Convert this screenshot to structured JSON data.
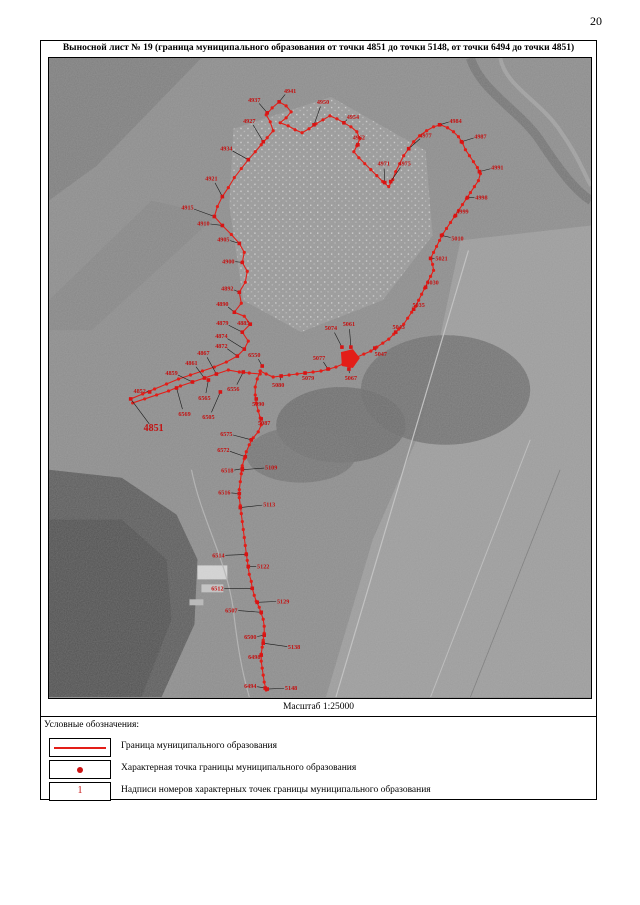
{
  "page": {
    "number": "20"
  },
  "sheet": {
    "title": "Выносной лист № 19 (граница муниципального образования от точки 4851 до точки 5148, от точки 6494 до точки 4851)",
    "scale_label": "Масштаб 1:25000"
  },
  "legend": {
    "heading": "Условные обозначения:",
    "items": [
      {
        "symbol": "boundary-line-symbol",
        "label": "Граница муниципального образования"
      },
      {
        "symbol": "boundary-point-symbol",
        "label": "Характерная точка границы муниципального образования"
      },
      {
        "symbol": "point-number-symbol",
        "label": "Надписи номеров характерных точек границы муниципального образования",
        "sample": "1"
      }
    ]
  },
  "colors": {
    "boundary": "#e31e18",
    "point": "#d81414",
    "label": "#c41111",
    "leader": "#1a1a1a",
    "map_base": "#8c8c8c"
  },
  "map": {
    "points": [
      {
        "n": "4851",
        "x": 152,
        "y": 428,
        "px": 129,
        "py": 399,
        "b": true
      },
      {
        "n": "4852",
        "x": 138,
        "y": 391,
        "px": 148,
        "py": 392
      },
      {
        "n": "4859",
        "x": 170,
        "y": 373,
        "px": 191,
        "py": 382
      },
      {
        "n": "4861",
        "x": 190,
        "y": 363,
        "px": 203,
        "py": 378
      },
      {
        "n": "4867",
        "x": 202,
        "y": 353,
        "px": 215,
        "py": 374
      },
      {
        "n": "4872",
        "x": 220,
        "y": 346,
        "px": 236,
        "py": 356
      },
      {
        "n": "4874",
        "x": 220,
        "y": 336,
        "px": 243,
        "py": 349
      },
      {
        "n": "4879",
        "x": 221,
        "y": 323,
        "px": 241,
        "py": 332
      },
      {
        "n": "4885",
        "x": 242,
        "y": 323,
        "px": 249,
        "py": 324
      },
      {
        "n": "4890",
        "x": 221,
        "y": 304,
        "px": 233,
        "py": 312
      },
      {
        "n": "4892",
        "x": 226,
        "y": 288,
        "px": 238,
        "py": 292
      },
      {
        "n": "4900",
        "x": 227,
        "y": 261,
        "px": 241,
        "py": 262
      },
      {
        "n": "4905",
        "x": 222,
        "y": 239,
        "px": 238,
        "py": 243
      },
      {
        "n": "4910",
        "x": 202,
        "y": 223,
        "px": 221,
        "py": 225
      },
      {
        "n": "4915",
        "x": 186,
        "y": 207,
        "px": 213,
        "py": 216
      },
      {
        "n": "4921",
        "x": 210,
        "y": 178,
        "px": 221,
        "py": 196
      },
      {
        "n": "4927",
        "x": 248,
        "y": 120,
        "px": 262,
        "py": 141
      },
      {
        "n": "4934",
        "x": 225,
        "y": 148,
        "px": 247,
        "py": 159
      },
      {
        "n": "4937",
        "x": 253,
        "y": 99,
        "px": 266,
        "py": 112
      },
      {
        "n": "4941",
        "x": 289,
        "y": 90,
        "px": 278,
        "py": 101
      },
      {
        "n": "4950",
        "x": 322,
        "y": 101,
        "px": 313,
        "py": 124
      },
      {
        "n": "4954",
        "x": 352,
        "y": 116,
        "px": 343,
        "py": 122
      },
      {
        "n": "4962",
        "x": 358,
        "y": 137,
        "px": 357,
        "py": 144
      },
      {
        "n": "4971",
        "x": 383,
        "y": 163,
        "px": 384,
        "py": 182
      },
      {
        "n": "4975",
        "x": 404,
        "y": 163,
        "px": 390,
        "py": 181
      },
      {
        "n": "4977",
        "x": 425,
        "y": 135,
        "px": 408,
        "py": 148
      },
      {
        "n": "4984",
        "x": 455,
        "y": 120,
        "px": 439,
        "py": 124
      },
      {
        "n": "4987",
        "x": 480,
        "y": 136,
        "px": 461,
        "py": 141
      },
      {
        "n": "4991",
        "x": 497,
        "y": 167,
        "px": 479,
        "py": 171
      },
      {
        "n": "4998",
        "x": 481,
        "y": 197,
        "px": 467,
        "py": 197
      },
      {
        "n": "4999",
        "x": 462,
        "y": 211,
        "px": 455,
        "py": 215
      },
      {
        "n": "5010",
        "x": 457,
        "y": 238,
        "px": 441,
        "py": 235
      },
      {
        "n": "5021",
        "x": 441,
        "y": 258,
        "px": 430,
        "py": 258
      },
      {
        "n": "5030",
        "x": 432,
        "y": 282,
        "px": 425,
        "py": 287
      },
      {
        "n": "5035",
        "x": 418,
        "y": 305,
        "px": 413,
        "py": 309
      },
      {
        "n": "5043",
        "x": 398,
        "y": 327,
        "px": 395,
        "py": 332
      },
      {
        "n": "5047",
        "x": 380,
        "y": 354,
        "px": 374,
        "py": 348
      },
      {
        "n": "5061",
        "x": 348,
        "y": 324,
        "px": 350,
        "py": 347
      },
      {
        "n": "5074",
        "x": 330,
        "y": 328,
        "px": 341,
        "py": 347
      },
      {
        "n": "5077",
        "x": 318,
        "y": 358,
        "px": 327,
        "py": 369
      },
      {
        "n": "5067",
        "x": 350,
        "y": 378,
        "px": 348,
        "py": 369
      },
      {
        "n": "5079",
        "x": 307,
        "y": 378,
        "px": 304,
        "py": 373
      },
      {
        "n": "5080",
        "x": 277,
        "y": 385,
        "px": 280,
        "py": 376
      },
      {
        "n": "6550",
        "x": 253,
        "y": 355,
        "px": 261,
        "py": 366
      },
      {
        "n": "6556",
        "x": 232,
        "y": 389,
        "px": 242,
        "py": 372
      },
      {
        "n": "6565",
        "x": 203,
        "y": 398,
        "px": 207,
        "py": 380
      },
      {
        "n": "6569",
        "x": 183,
        "y": 414,
        "px": 175,
        "py": 388
      },
      {
        "n": "6505",
        "x": 207,
        "y": 417,
        "px": 219,
        "py": 392
      },
      {
        "n": "5090",
        "x": 257,
        "y": 404,
        "px": 255,
        "py": 399
      },
      {
        "n": "5087",
        "x": 263,
        "y": 423,
        "px": 260,
        "py": 419
      },
      {
        "n": "6575",
        "x": 225,
        "y": 434,
        "px": 250,
        "py": 440
      },
      {
        "n": "6572",
        "x": 222,
        "y": 450,
        "px": 244,
        "py": 457
      },
      {
        "n": "6518",
        "x": 226,
        "y": 471,
        "px": 241,
        "py": 469
      },
      {
        "n": "5109",
        "x": 270,
        "y": 468,
        "px": 241,
        "py": 470
      },
      {
        "n": "6516",
        "x": 223,
        "y": 493,
        "px": 238,
        "py": 494
      },
      {
        "n": "5113",
        "x": 268,
        "y": 505,
        "px": 239,
        "py": 508
      },
      {
        "n": "6514",
        "x": 217,
        "y": 556,
        "px": 245,
        "py": 555
      },
      {
        "n": "5122",
        "x": 262,
        "y": 567,
        "px": 247,
        "py": 567
      },
      {
        "n": "6512",
        "x": 216,
        "y": 589,
        "px": 251,
        "py": 589
      },
      {
        "n": "5129",
        "x": 282,
        "y": 602,
        "px": 256,
        "py": 603
      },
      {
        "n": "6507",
        "x": 230,
        "y": 611,
        "px": 260,
        "py": 613
      },
      {
        "n": "6500",
        "x": 249,
        "y": 638,
        "px": 263,
        "py": 636
      },
      {
        "n": "5138",
        "x": 293,
        "y": 648,
        "px": 262,
        "py": 644
      },
      {
        "n": "6498",
        "x": 253,
        "y": 658,
        "px": 260,
        "py": 656
      },
      {
        "n": "6494",
        "x": 249,
        "y": 687,
        "px": 264,
        "py": 689
      },
      {
        "n": "5148",
        "x": 290,
        "y": 689,
        "px": 266,
        "py": 690
      }
    ],
    "paths": {
      "outer": [
        [
          129,
          399
        ],
        [
          141,
          394
        ],
        [
          153,
          389
        ],
        [
          165,
          384
        ],
        [
          177,
          379
        ],
        [
          189,
          375
        ],
        [
          201,
          371
        ],
        [
          213,
          367
        ],
        [
          225,
          362
        ],
        [
          236,
          356
        ],
        [
          243,
          349
        ],
        [
          247,
          341
        ],
        [
          241,
          332
        ],
        [
          249,
          324
        ],
        [
          243,
          316
        ],
        [
          233,
          312
        ],
        [
          240,
          303
        ],
        [
          238,
          292
        ],
        [
          244,
          282
        ],
        [
          246,
          271
        ],
        [
          241,
          262
        ],
        [
          243,
          252
        ],
        [
          238,
          243
        ],
        [
          230,
          234
        ],
        [
          221,
          225
        ],
        [
          213,
          216
        ],
        [
          216,
          206
        ],
        [
          221,
          196
        ],
        [
          227,
          187
        ],
        [
          233,
          177
        ],
        [
          240,
          168
        ],
        [
          247,
          159
        ],
        [
          254,
          151
        ],
        [
          260,
          144
        ],
        [
          266,
          137
        ],
        [
          272,
          130
        ],
        [
          269,
          121
        ],
        [
          265,
          114
        ],
        [
          271,
          107
        ],
        [
          278,
          101
        ],
        [
          285,
          105
        ],
        [
          290,
          111
        ],
        [
          285,
          117
        ],
        [
          279,
          122
        ],
        [
          287,
          125
        ],
        [
          294,
          129
        ],
        [
          301,
          132
        ],
        [
          308,
          128
        ],
        [
          315,
          123
        ],
        [
          322,
          119
        ],
        [
          329,
          115
        ],
        [
          336,
          118
        ],
        [
          343,
          122
        ],
        [
          350,
          126
        ],
        [
          356,
          131
        ],
        [
          359,
          138
        ],
        [
          356,
          145
        ],
        [
          353,
          151
        ],
        [
          358,
          157
        ],
        [
          364,
          163
        ],
        [
          370,
          169
        ],
        [
          376,
          175
        ],
        [
          382,
          181
        ],
        [
          388,
          186
        ],
        [
          392,
          179
        ],
        [
          395,
          171
        ],
        [
          399,
          163
        ],
        [
          403,
          155
        ],
        [
          408,
          148
        ],
        [
          413,
          141
        ],
        [
          419,
          135
        ],
        [
          426,
          130
        ],
        [
          433,
          126
        ],
        [
          440,
          124
        ],
        [
          447,
          127
        ],
        [
          453,
          131
        ],
        [
          458,
          136
        ],
        [
          462,
          142
        ],
        [
          465,
          149
        ],
        [
          469,
          155
        ],
        [
          473,
          161
        ],
        [
          477,
          167
        ],
        [
          480,
          173
        ],
        [
          478,
          180
        ],
        [
          474,
          186
        ],
        [
          470,
          192
        ],
        [
          466,
          198
        ],
        [
          462,
          204
        ],
        [
          458,
          210
        ],
        [
          454,
          216
        ],
        [
          450,
          222
        ],
        [
          446,
          228
        ],
        [
          442,
          234
        ],
        [
          439,
          240
        ],
        [
          436,
          246
        ],
        [
          433,
          252
        ],
        [
          430,
          258
        ],
        [
          432,
          264
        ],
        [
          433,
          270
        ],
        [
          430,
          276
        ],
        [
          427,
          282
        ],
        [
          424,
          288
        ],
        [
          421,
          294
        ],
        [
          418,
          300
        ],
        [
          415,
          306
        ],
        [
          411,
          312
        ],
        [
          407,
          318
        ],
        [
          403,
          324
        ],
        [
          398,
          329
        ],
        [
          393,
          334
        ],
        [
          388,
          339
        ],
        [
          382,
          343
        ],
        [
          376,
          347
        ],
        [
          370,
          351
        ],
        [
          363,
          354
        ],
        [
          356,
          357
        ],
        [
          349,
          361
        ],
        [
          342,
          364
        ],
        [
          335,
          367
        ],
        [
          328,
          369
        ],
        [
          320,
          371
        ],
        [
          312,
          372
        ],
        [
          304,
          373
        ],
        [
          296,
          374
        ],
        [
          288,
          375
        ],
        [
          280,
          376
        ],
        [
          272,
          377
        ],
        [
          265,
          374
        ],
        [
          259,
          371
        ]
      ],
      "parallel": [
        [
          131,
          403
        ],
        [
          143,
          399
        ],
        [
          155,
          395
        ],
        [
          167,
          391
        ],
        [
          179,
          386
        ],
        [
          191,
          382
        ],
        [
          203,
          378
        ],
        [
          215,
          374
        ],
        [
          227,
          370
        ],
        [
          238,
          372
        ],
        [
          248,
          373
        ],
        [
          259,
          374
        ]
      ],
      "south": [
        [
          259,
          371
        ],
        [
          256,
          379
        ],
        [
          254,
          387
        ],
        [
          254,
          395
        ],
        [
          255,
          403
        ],
        [
          257,
          411
        ],
        [
          259,
          418
        ],
        [
          260,
          425
        ],
        [
          257,
          432
        ],
        [
          252,
          438
        ],
        [
          248,
          445
        ],
        [
          245,
          452
        ],
        [
          243,
          459
        ],
        [
          241,
          466
        ],
        [
          240,
          474
        ],
        [
          239,
          482
        ],
        [
          238,
          490
        ],
        [
          238,
          498
        ],
        [
          239,
          506
        ],
        [
          240,
          514
        ],
        [
          241,
          522
        ],
        [
          242,
          530
        ],
        [
          243,
          538
        ],
        [
          244,
          546
        ],
        [
          245,
          554
        ],
        [
          246,
          561
        ],
        [
          247,
          568
        ],
        [
          248,
          575
        ],
        [
          250,
          582
        ],
        [
          251,
          589
        ],
        [
          253,
          596
        ],
        [
          255,
          602
        ],
        [
          258,
          608
        ],
        [
          260,
          614
        ],
        [
          262,
          620
        ],
        [
          263,
          627
        ],
        [
          263,
          634
        ],
        [
          262,
          641
        ],
        [
          261,
          648
        ],
        [
          260,
          655
        ],
        [
          260,
          662
        ],
        [
          261,
          669
        ],
        [
          262,
          676
        ],
        [
          263,
          683
        ],
        [
          265,
          691
        ]
      ]
    },
    "blob": [
      [
        340,
        352
      ],
      [
        352,
        349
      ],
      [
        359,
        358
      ],
      [
        352,
        368
      ],
      [
        341,
        366
      ]
    ]
  }
}
